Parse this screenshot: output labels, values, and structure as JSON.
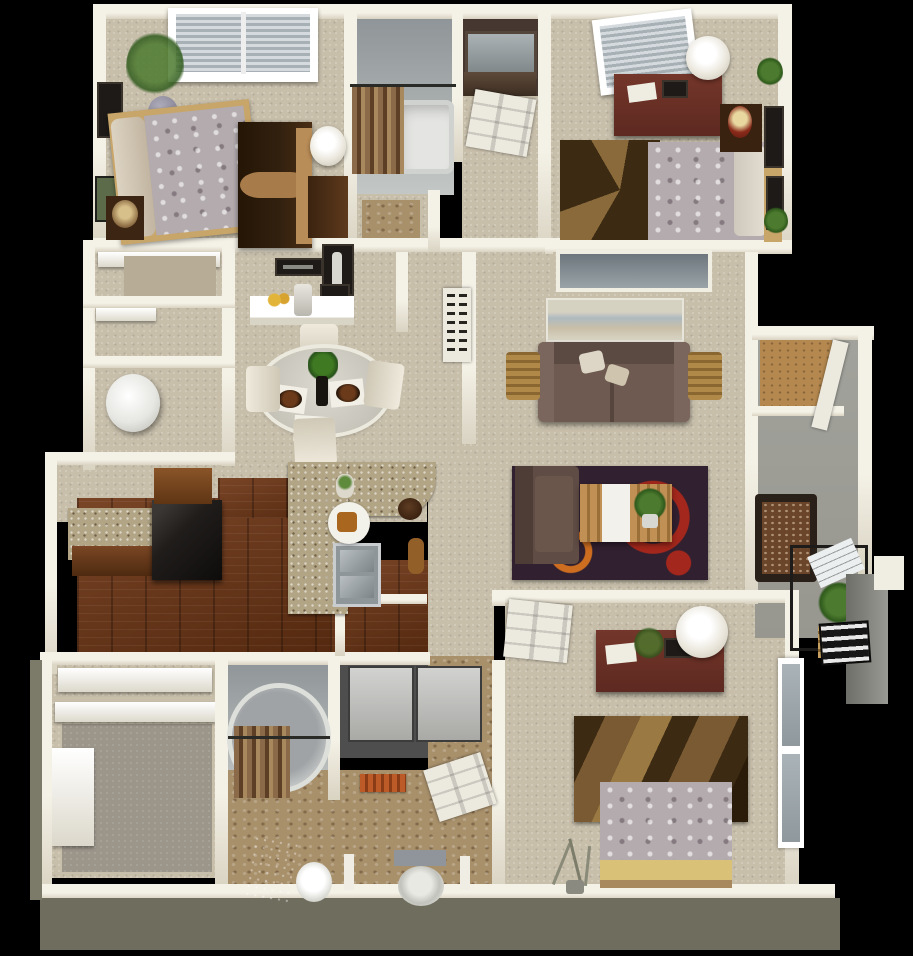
{
  "meta": {
    "image_type": "3d-floor-plan-render",
    "description": "Top-down 3D rendering of a three-bedroom, two-bathroom apartment floor plan on a black background"
  },
  "colors": {
    "background": "#000000",
    "wall": "#f4f1e6",
    "wall_shade": "#d9d3c2",
    "outer_face": "#6f6e5e",
    "carpet": "#c8bfab",
    "carpet_dark": "#b7ad97",
    "closet_carpet": "#9b958a",
    "wood_floor": "#7a4527",
    "wood_floor_dark": "#54290f",
    "granite": "#b2a585",
    "cabinet_wood": "#6b3a20",
    "appliance_black": "#201d1b",
    "tile_gray": "#a2a7a8",
    "tile_tan": "#a8906b",
    "concrete": "#97978f",
    "tub_white": "#e4e5e2",
    "curtain_brown": "#7d5c3c",
    "sofa_brown": "#6e5a50",
    "chair_brown": "#5f4c44",
    "rug_plum": "#31202f",
    "rug_red": "#a3271c",
    "rug_orange": "#cd6d20",
    "rug_tan": "#7a5a33",
    "rug_tan_dark": "#3c2a12",
    "bed_gray": "#b3abad",
    "bed_trim_tan": "#c8a568",
    "bed_yellow": "#d9c178",
    "dresser_red": "#5d2921",
    "armoire_dark": "#32200f",
    "armoire_band": "#a87c4a",
    "lamp_white": "#e9e5da",
    "door_white": "#ece9df",
    "window_gray": "#9aa3a8",
    "plant_green": "#4c7a2e",
    "towel_orange": "#bc5a28",
    "basket_tan": "#b08848",
    "newspaper_white": "#eceff0",
    "red_lamp": "#8a2a1a",
    "water_heater": "#e6e6e2",
    "stairs_dark": "#161616"
  },
  "rooms": {
    "bedroom1": {
      "label": "Bedroom 1"
    },
    "bathroom1": {
      "label": "Bathroom"
    },
    "vanity": {
      "label": "Vanity Nook"
    },
    "entry": {
      "label": "Entry Closet"
    },
    "bedroom2": {
      "label": "Bedroom 2"
    },
    "closets": {
      "label": "Hall Closets"
    },
    "utility": {
      "label": "Utility Closet"
    },
    "dining": {
      "label": "Dining Area"
    },
    "living": {
      "label": "Living Room"
    },
    "kitchen": {
      "label": "Kitchen"
    },
    "walkin": {
      "label": "Walk-in Closet"
    },
    "bathroom2": {
      "label": "Master Bathroom"
    },
    "bedroom3": {
      "label": "Bedroom 3"
    },
    "balcony": {
      "label": "Balcony / Patio"
    }
  }
}
